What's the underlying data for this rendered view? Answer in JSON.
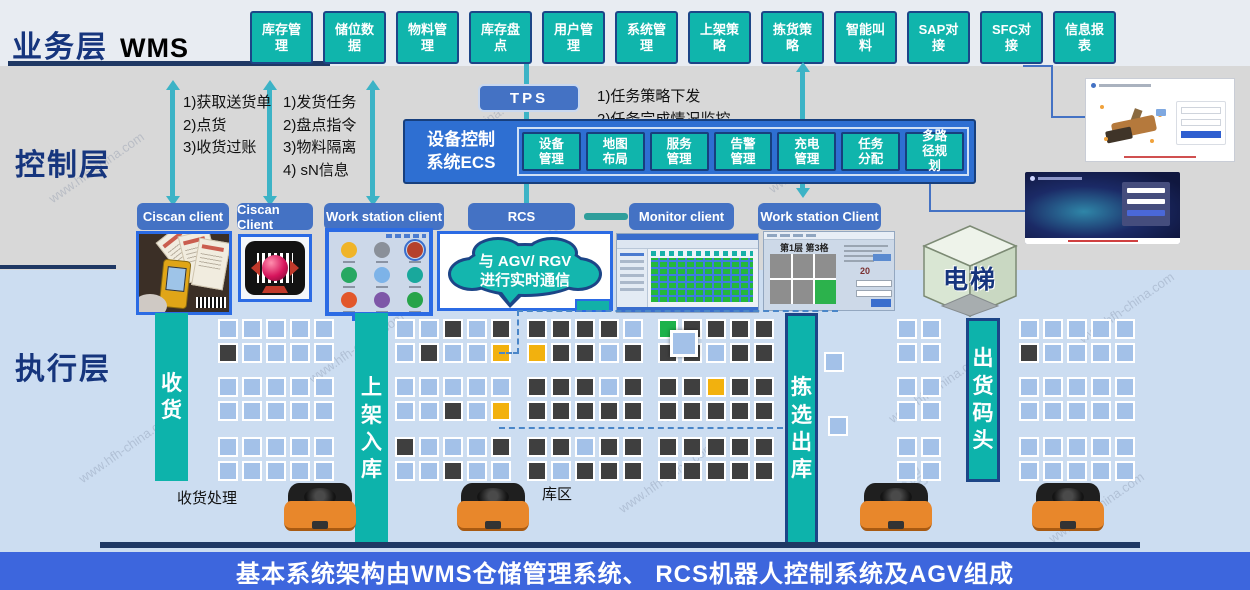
{
  "layers": {
    "business": {
      "label": "业务层",
      "sublabel": "WMS"
    },
    "control": {
      "label": "控制层"
    },
    "execution": {
      "label": "执行层"
    }
  },
  "business_modules": [
    "库存管理",
    "储位数据",
    "物料管理",
    "库存盘点",
    "用户管理",
    "系统管理",
    "上架策略",
    "拣货策略",
    "智能叫料",
    "SAP对接",
    "SFC对接",
    "信息报表"
  ],
  "flow_notes": {
    "receiving": "1)获取送货单\n2)点货\n3)收货过账",
    "shipping": "1)发货任务\n2)盘点指令\n3)物料隔离\n4) sN信息",
    "tps": "1)任务策略下发\n2)任务完成情况监控"
  },
  "tps": {
    "label": "TPS"
  },
  "ecs": {
    "title": "设备控制\n系统ECS",
    "modules": [
      "设备管理",
      "地图布局",
      "服务管理",
      "告警管理",
      "充电管理",
      "任务分配",
      "多路径规划"
    ]
  },
  "clients": [
    "Ciscan client",
    "Ciscan Client",
    "Work station client",
    "RCS",
    "Monitor client",
    "Work station Client"
  ],
  "agv_cloud": {
    "text": "与 AGV/ RGV\n进行实时通信"
  },
  "elevator": {
    "label": "电梯"
  },
  "flow_bars": {
    "receive": "收货",
    "putaway": "上架入库",
    "pick": "拣选出库",
    "dock": "出货码头"
  },
  "area_labels": {
    "receiving_handling": "收货处理",
    "storage_zone": "库区"
  },
  "monitor_screen": {
    "title": "第1层 第3格",
    "value": "20"
  },
  "footer": {
    "text": "基本系统架构由WMS仓储管理系统、 RCS机器人控制系统及AGV组成"
  },
  "watermark": {
    "site": "www.hfh-china.com",
    "brand": "鸿富华智能"
  },
  "colors": {
    "module_teal": "#10b5ac",
    "box_blue": "#4472c4",
    "navy": "#1c4587",
    "cell_blue": "#a3c1e8",
    "cell_dark": "#3f3f3f",
    "cell_orange": "#f2b10e",
    "cell_green": "#1cb24b",
    "arrow_teal": "#3cb3c6",
    "footer_blue": "#3d66dd"
  },
  "warehouse": {
    "groups": [
      {
        "name": "receiving-racks",
        "x": 218,
        "y": 319,
        "bands": [
          [
            "bbbbb",
            "dbbbb"
          ],
          [
            "bbbbb",
            "bbbbb"
          ],
          [
            "bbbbb",
            "bbbbb"
          ]
        ]
      },
      {
        "name": "putaway-racks",
        "x": 395,
        "y": 319,
        "bands": [
          [
            "bbdbd",
            "bdbbo"
          ],
          [
            "bbbbb",
            "bbdbo"
          ],
          [
            "dbbbd",
            "bbdbb"
          ]
        ]
      },
      {
        "name": "storage-racks-1",
        "x": 527,
        "y": 319,
        "bands": [
          [
            "ddddb",
            "oddbd"
          ],
          [
            "dddbd",
            "ddddd"
          ],
          [
            "ddbdd",
            "dbddd"
          ]
        ]
      },
      {
        "name": "storage-racks-2",
        "x": 658,
        "y": 319,
        "bands": [
          [
            "gdddd",
            "ddbdd"
          ],
          [
            "ddodd",
            "ddddd"
          ],
          [
            "ddddd",
            "ddddd"
          ]
        ]
      },
      {
        "name": "outbound-buffer",
        "x": 897,
        "y": 319,
        "bands": [
          [
            "bb",
            "bb"
          ],
          [
            "bb",
            "bb"
          ],
          [
            "bb",
            "bb"
          ]
        ]
      },
      {
        "name": "dock-racks",
        "x": 1019,
        "y": 319,
        "bands": [
          [
            "bbbbb",
            "dbbbb"
          ],
          [
            "bbbbb",
            "bbbbb"
          ],
          [
            "bbbbb",
            "bbbbb"
          ]
        ]
      }
    ],
    "singles": [
      {
        "x": 824,
        "y": 352,
        "c": "b"
      },
      {
        "x": 828,
        "y": 416,
        "c": "b"
      }
    ]
  }
}
